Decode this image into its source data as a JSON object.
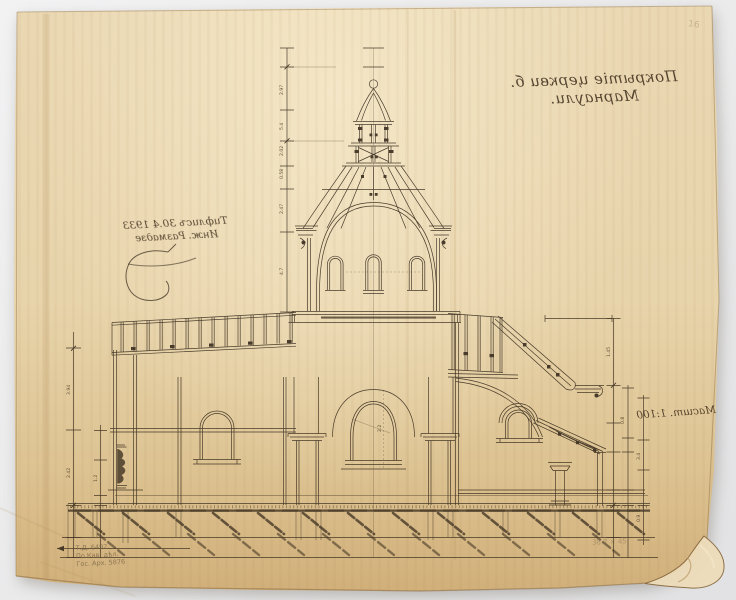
{
  "photo": {
    "background_color": "#ebebec",
    "paper_color": "#e8d4ab",
    "ink_color": "#372b1d"
  },
  "inscriptions": {
    "title": "Покрытіе церкви б. Марнаули.",
    "date_line1": "Тифлисъ 30.4 1933",
    "date_line2": "Инж. Размадзе",
    "scale": "Масшт. 1:100"
  },
  "pencil_notes": {
    "inventory_line1": "Т.Д. 6492.",
    "inventory_line2": "По Кав. дѣл.",
    "inventory_line3": "Гос. Арх. 5876",
    "size_note": "38.7 × 45",
    "corner_mark": "16"
  },
  "dimension_labels": [
    "2.97",
    "5.4",
    "2.02",
    "0.58",
    "2.47",
    "4.7",
    "3.94",
    "2.42",
    "1.2",
    "1.45",
    "0.8",
    "3.4",
    "0.9",
    "2.2"
  ]
}
